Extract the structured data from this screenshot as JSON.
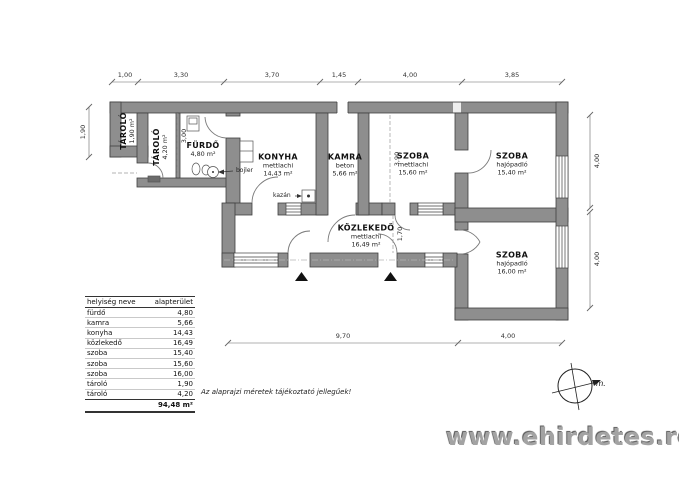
{
  "plan": {
    "rooms": [
      {
        "id": "tarolo-small",
        "name": "TÁROLÓ",
        "area": "1,90 m²"
      },
      {
        "id": "tarolo",
        "name": "TÁROLÓ",
        "area": "4,20 m²"
      },
      {
        "id": "furdo",
        "name": "FÜRDŐ",
        "area": "4,80 m²"
      },
      {
        "id": "konyha",
        "name": "KONYHA",
        "floor": "mettlachi",
        "area": "14,43 m²"
      },
      {
        "id": "kamra",
        "name": "KAMRA",
        "floor": "beton",
        "area": "5,66 m²"
      },
      {
        "id": "szoba-1",
        "name": "SZOBA",
        "floor": "mettlachi",
        "area": "15,60 m²"
      },
      {
        "id": "szoba-2",
        "name": "SZOBA",
        "floor": "hajópadló",
        "area": "15,40 m²"
      },
      {
        "id": "kozlekedo",
        "name": "KÖZLEKEDŐ",
        "floor": "mettlachi",
        "area": "16,49 m²"
      },
      {
        "id": "szoba-3",
        "name": "SZOBA",
        "floor": "hajópadló",
        "area": "16,00 m²"
      }
    ],
    "annotations": {
      "bojler": "bojler",
      "kazan": "kazán"
    },
    "dimensions": {
      "top": [
        "1,00",
        "3,30",
        "3,70",
        "1,45",
        "4,00",
        "3,85"
      ],
      "left": [
        "1,90"
      ],
      "right": [
        "4,00",
        "4,00"
      ],
      "bottom": [
        "9,70",
        "4,00"
      ],
      "interior": [
        "3,00",
        "3,90",
        "1,70"
      ]
    },
    "compass_label": "m."
  },
  "table": {
    "headers": [
      "helyiség neve",
      "alapterület"
    ],
    "rows": [
      [
        "fürdő",
        "4,80"
      ],
      [
        "kamra",
        "5,66"
      ],
      [
        "konyha",
        "14,43"
      ],
      [
        "közlekedő",
        "16,49"
      ],
      [
        "szoba",
        "15,40"
      ],
      [
        "szoba",
        "15,60"
      ],
      [
        "szoba",
        "16,00"
      ],
      [
        "tároló",
        "1,90"
      ],
      [
        "tároló",
        "4,20"
      ]
    ],
    "total": "94,48 m²"
  },
  "note": "Az alaprajzi méretek tájékoztató jellegűek!",
  "watermark": "www.ehirdetes.ro",
  "colors": {
    "wall_fill": "#8e8e8e",
    "wall_stroke": "#3f3f3f",
    "accent_black": "#111111"
  }
}
